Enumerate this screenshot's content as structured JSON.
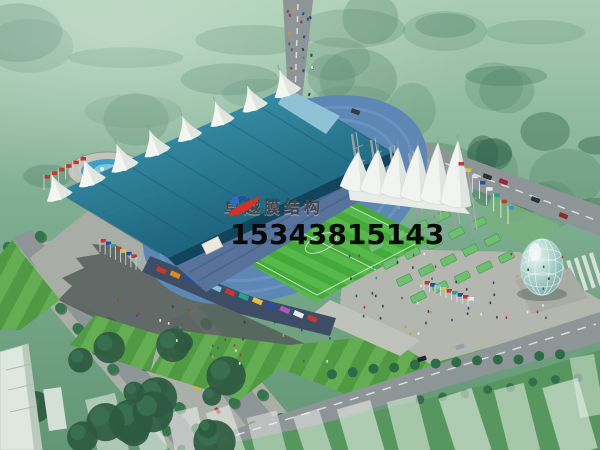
{
  "watermark": {
    "brand": "卓越膜结构",
    "phone": "15343815143",
    "logo": "red-blue-swoosh-logo"
  },
  "scene": {
    "subject": "stadium-aerial-rendering",
    "landmarks": [
      "membrane-tent-roof-grandstand",
      "white-canopy-east-stand",
      "striped-football-pitch",
      "circular-fountain-plaza",
      "tree-lined-boulevard",
      "glass-dome-pavilion",
      "flag-rows",
      "perimeter-roads",
      "translucent-city-blocks",
      "tree-canopy"
    ]
  },
  "colors": {
    "treeHazeTop": "#a8cdb2",
    "treeMid": "#7fae92",
    "treeDark": "#35634a",
    "road": "#8e9596",
    "roadLine": "#d8dcda",
    "plazaLight": "#b4b7b0",
    "shadow": "#525b58",
    "pitchGreen": "#46a93c",
    "pitchStripe": "#56ba4a",
    "roofTeal": "#2f86a0",
    "membraneWhite": "#f2f5f1",
    "standsBlue": "#5d87b5",
    "fountainBlue": "#3f9fc4",
    "domeGlass": "#8fbcba",
    "lawnLight": "#64ad52",
    "lawnDark": "#4f9a43",
    "benchGreen": "#6fbf72",
    "flagRed": "#c23a2e",
    "brandText": "#41464a",
    "phoneText": "#0a0a0a",
    "logoBlue": "#2f6db8",
    "logoRed": "#d2302a"
  }
}
